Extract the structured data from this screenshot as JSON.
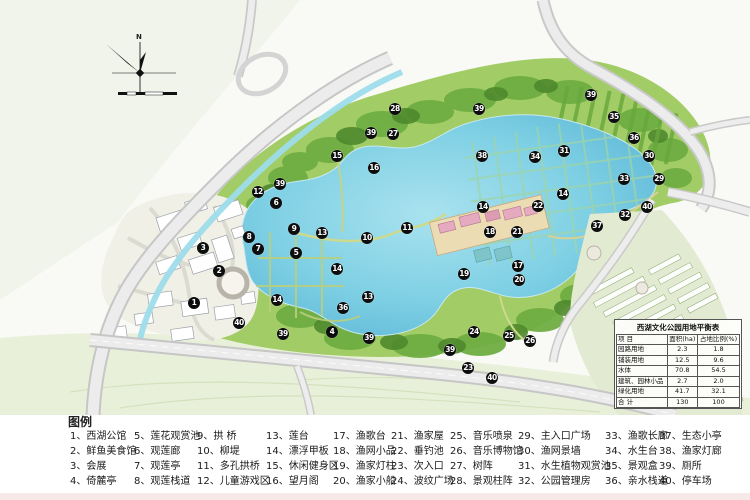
{
  "map": {
    "north_label": "N",
    "colors": {
      "lake": "#6ec4dd",
      "park_green": "#a2cc66",
      "dark_tree": "#4e8a2d",
      "road": "#e3e3e3",
      "river": "#9ddcea",
      "marker_bg": "#0d0d0d",
      "island_building": "#e5aac0"
    }
  },
  "table": {
    "title": "西湖文化公园用地平衡表",
    "headers": [
      "项  目",
      "面积(ha)",
      "占地比例(%)"
    ],
    "rows": [
      [
        "园路用地",
        "2.3",
        "1.8"
      ],
      [
        "铺装用地",
        "12.5",
        "9.6"
      ],
      [
        "水体",
        "70.8",
        "54.5"
      ],
      [
        "建筑、园林小品",
        "2.7",
        "2.0"
      ],
      [
        "绿化用地",
        "41.7",
        "32.1"
      ],
      [
        "合  计",
        "130",
        "100"
      ]
    ]
  },
  "legend": {
    "title": "图例",
    "items": [
      {
        "num": "1",
        "label": "西湖公馆"
      },
      {
        "num": "2",
        "label": "鲜鱼美食馆"
      },
      {
        "num": "3",
        "label": "会展"
      },
      {
        "num": "4",
        "label": "倚麓亭"
      },
      {
        "num": "5",
        "label": "莲花观赏池"
      },
      {
        "num": "6",
        "label": "观莲廊"
      },
      {
        "num": "7",
        "label": "观莲亭"
      },
      {
        "num": "8",
        "label": "观莲栈道"
      },
      {
        "num": "9",
        "label": "拱 桥"
      },
      {
        "num": "10",
        "label": "柳堤"
      },
      {
        "num": "11",
        "label": "多孔拱桥"
      },
      {
        "num": "12",
        "label": "儿童游戏区"
      },
      {
        "num": "13",
        "label": "莲台"
      },
      {
        "num": "14",
        "label": "漂浮甲板"
      },
      {
        "num": "15",
        "label": "休闲健身区"
      },
      {
        "num": "16",
        "label": "望月阁"
      },
      {
        "num": "17",
        "label": "渔歌台"
      },
      {
        "num": "18",
        "label": "渔网小品"
      },
      {
        "num": "19",
        "label": "渔家灯柱"
      },
      {
        "num": "20",
        "label": "渔家小船"
      },
      {
        "num": "21",
        "label": "渔家屋"
      },
      {
        "num": "22",
        "label": "垂钓池"
      },
      {
        "num": "23",
        "label": "次入口"
      },
      {
        "num": "24",
        "label": "波纹广场"
      },
      {
        "num": "25",
        "label": "音乐喷泉"
      },
      {
        "num": "26",
        "label": "音乐博物馆"
      },
      {
        "num": "27",
        "label": "树阵"
      },
      {
        "num": "28",
        "label": "景观柱阵"
      },
      {
        "num": "29",
        "label": "主入口广场"
      },
      {
        "num": "30",
        "label": "渔网景墙"
      },
      {
        "num": "31",
        "label": "水生植物观赏池"
      },
      {
        "num": "32",
        "label": "公园管理房"
      },
      {
        "num": "33",
        "label": "渔歌长廊"
      },
      {
        "num": "34",
        "label": "水生台"
      },
      {
        "num": "35",
        "label": "景观盒"
      },
      {
        "num": "36",
        "label": "亲水栈道"
      },
      {
        "num": "37",
        "label": "生态小亭"
      },
      {
        "num": "38",
        "label": "渔家灯廊"
      },
      {
        "num": "39",
        "label": "厕所"
      },
      {
        "num": "40",
        "label": "停车场"
      }
    ]
  },
  "markers": [
    [
      1,
      194,
      303
    ],
    [
      2,
      219,
      271
    ],
    [
      3,
      203,
      248
    ],
    [
      4,
      332,
      332
    ],
    [
      5,
      296,
      253
    ],
    [
      6,
      276,
      203
    ],
    [
      7,
      258,
      249
    ],
    [
      8,
      249,
      237
    ],
    [
      9,
      294,
      229
    ],
    [
      10,
      367,
      238
    ],
    [
      11,
      407,
      228
    ],
    [
      12,
      258,
      192
    ],
    [
      13,
      322,
      233
    ],
    [
      13,
      368,
      297
    ],
    [
      14,
      337,
      269
    ],
    [
      14,
      483,
      207
    ],
    [
      14,
      563,
      194
    ],
    [
      14,
      277,
      300
    ],
    [
      15,
      337,
      156
    ],
    [
      16,
      374,
      168
    ],
    [
      17,
      518,
      266
    ],
    [
      18,
      490,
      232
    ],
    [
      19,
      464,
      274
    ],
    [
      20,
      519,
      280
    ],
    [
      21,
      517,
      232
    ],
    [
      22,
      538,
      206
    ],
    [
      23,
      468,
      368
    ],
    [
      24,
      474,
      332
    ],
    [
      25,
      509,
      336
    ],
    [
      26,
      530,
      341
    ],
    [
      27,
      393,
      134
    ],
    [
      28,
      395,
      109
    ],
    [
      29,
      659,
      179
    ],
    [
      30,
      649,
      156
    ],
    [
      31,
      564,
      151
    ],
    [
      32,
      625,
      215
    ],
    [
      33,
      624,
      179
    ],
    [
      34,
      535,
      157
    ],
    [
      35,
      614,
      117
    ],
    [
      36,
      634,
      138
    ],
    [
      36,
      343,
      308
    ],
    [
      37,
      597,
      226
    ],
    [
      38,
      482,
      156
    ],
    [
      39,
      280,
      184
    ],
    [
      39,
      371,
      133
    ],
    [
      39,
      479,
      109
    ],
    [
      39,
      591,
      95
    ],
    [
      39,
      283,
      334
    ],
    [
      39,
      369,
      338
    ],
    [
      39,
      450,
      350
    ],
    [
      40,
      239,
      323
    ],
    [
      40,
      492,
      378
    ],
    [
      40,
      647,
      207
    ]
  ]
}
